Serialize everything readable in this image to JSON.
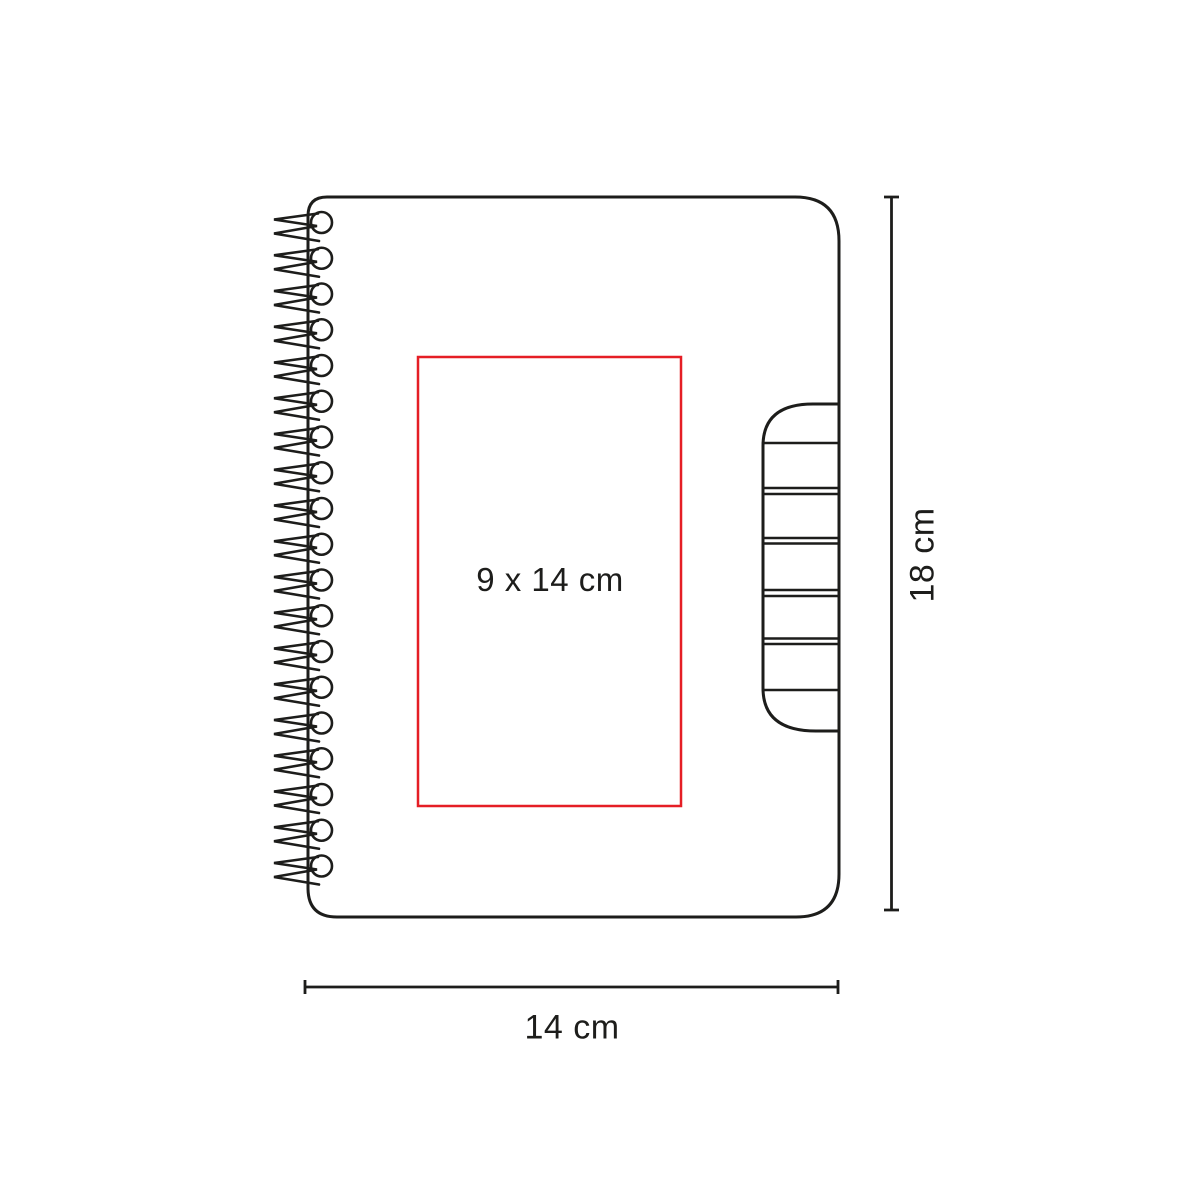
{
  "diagram": {
    "title": "spiral-notebook-print-area-diagram",
    "product": "spiral notebook with rounded cover and side index tab",
    "print_area": {
      "label": "9 x 14 cm"
    },
    "dimensions": {
      "height": "18 cm",
      "width": "14 cm"
    },
    "spiral": {
      "loops": 19
    },
    "colors": {
      "line": "#1d1d1b",
      "accent_red": "#e51e25",
      "background": "#ffffff"
    }
  }
}
